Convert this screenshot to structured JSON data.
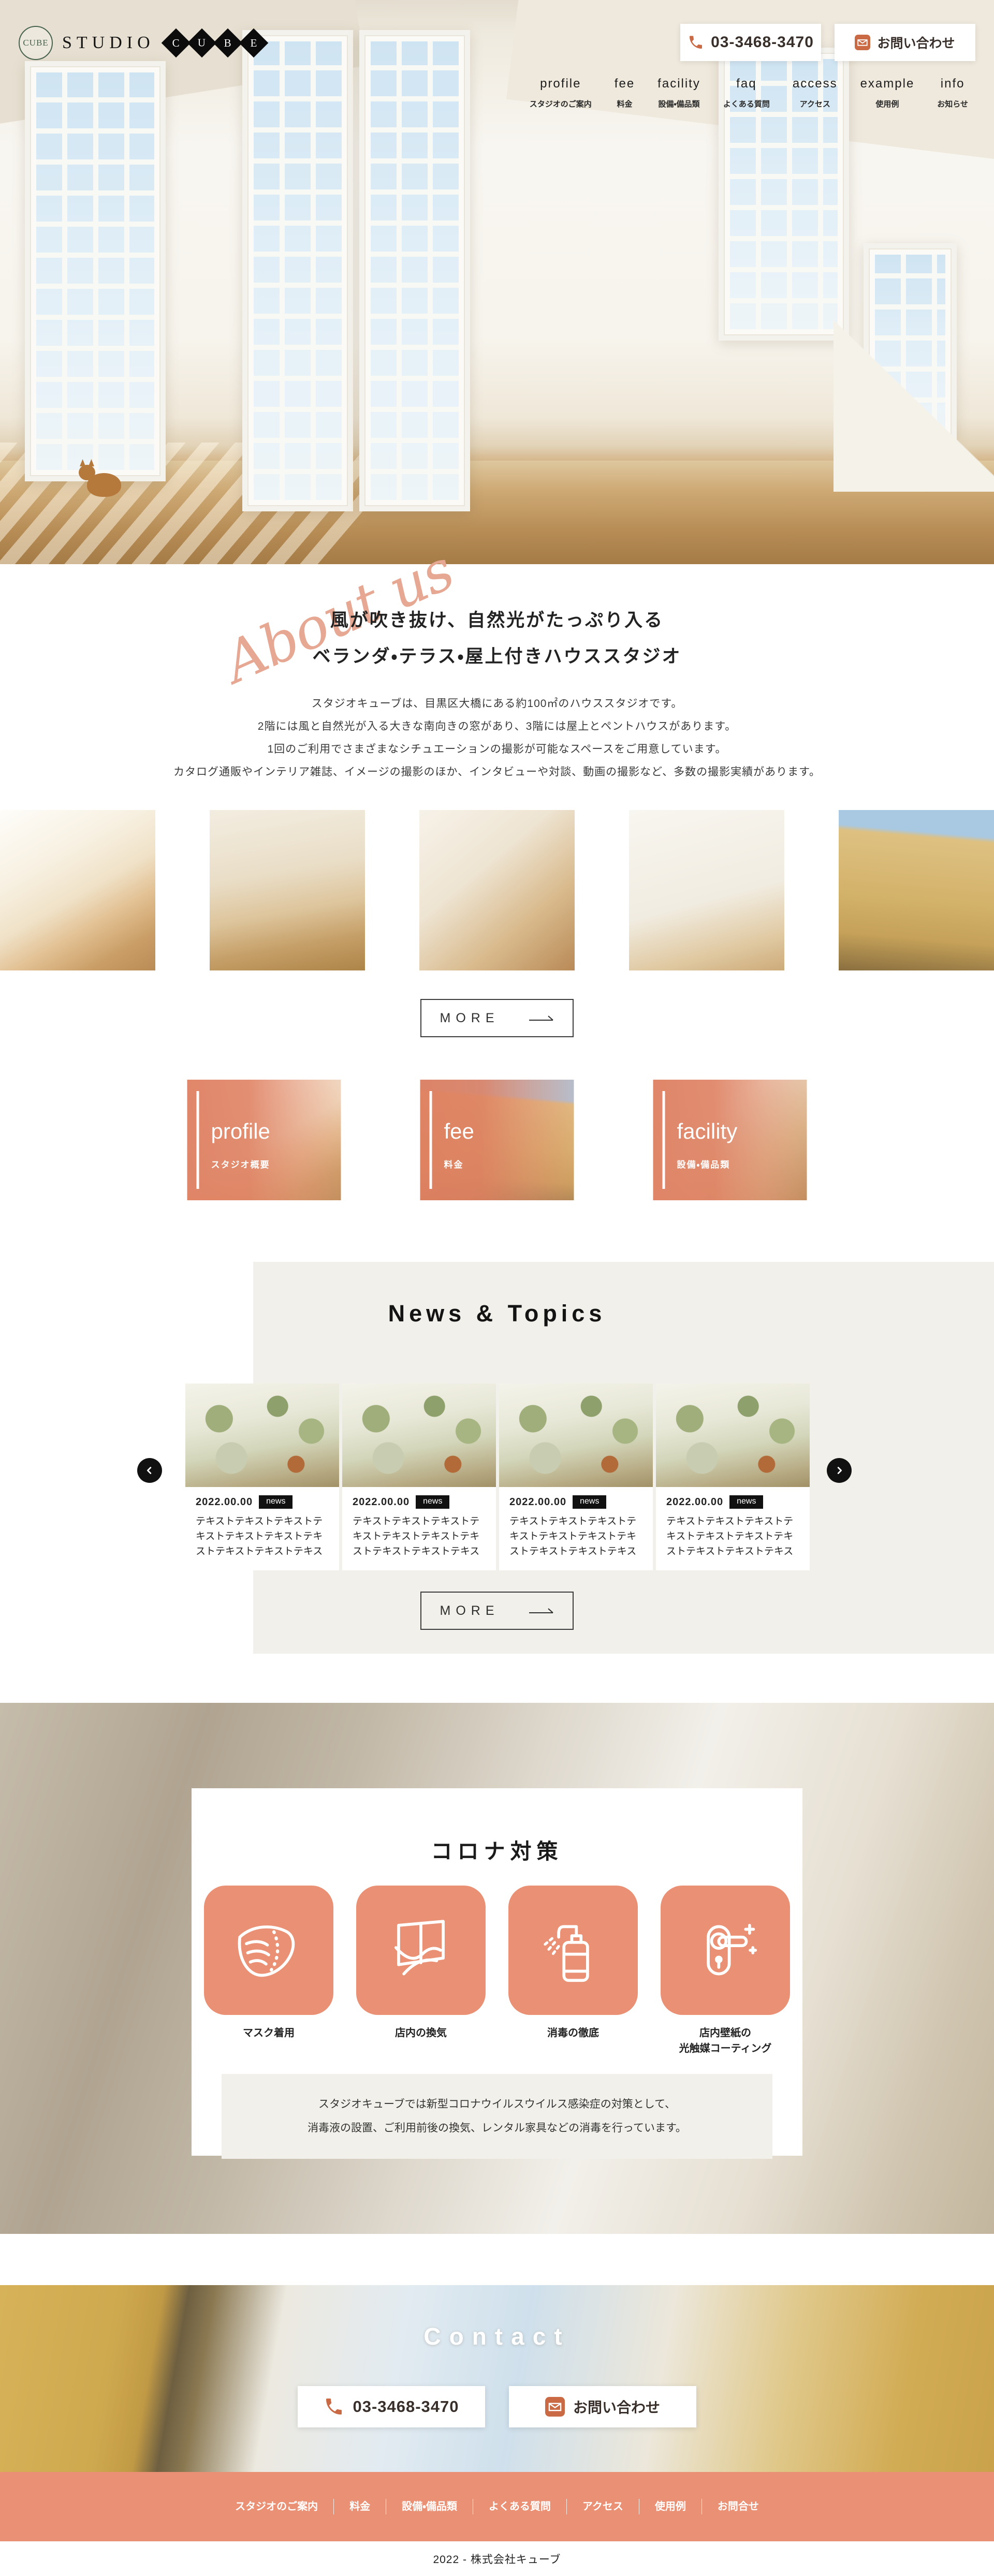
{
  "logo": {
    "emblem": "CUBE",
    "studio": "STUDIO",
    "cube": [
      "C",
      "U",
      "B",
      "E"
    ]
  },
  "header": {
    "phone": "03-3468-3470",
    "contact_label": "お問い合わせ",
    "nav": [
      {
        "en": "profile",
        "jp": "スタジオのご案内"
      },
      {
        "en": "fee",
        "jp": "料金"
      },
      {
        "en": "facility",
        "jp": "設備・備品類"
      },
      {
        "en": "faq",
        "jp": "よくある質問"
      },
      {
        "en": "access",
        "jp": "アクセス"
      },
      {
        "en": "example",
        "jp": "使用例"
      },
      {
        "en": "info",
        "jp": "お知らせ"
      }
    ]
  },
  "about": {
    "script": "About us",
    "heading1": "風が吹き抜け、自然光がたっぷり入る",
    "heading2": "ベランダ・テラス・屋上付きハウススタジオ",
    "p1": "スタジオキューブは、目黒区大橋にある約100㎡のハウススタジオです。",
    "p2": "2階には風と自然光が入る大きな南向きの窓があり、3階には屋上とペントハウスがあります。",
    "p3": "1回のご利用でさまざまなシチュエーションの撮影が可能なスペースをご用意しています。",
    "p4": "カタログ通販やインテリア雑誌、イメージの撮影のほか、インタビューや対談、動画の撮影など、多数の撮影実績があります。",
    "more": "MORE"
  },
  "menu_cards": [
    {
      "en": "profile",
      "jp": "スタジオ概要"
    },
    {
      "en": "fee",
      "jp": "料金"
    },
    {
      "en": "facility",
      "jp": "設備・備品類"
    }
  ],
  "news": {
    "title": "News & Topics",
    "more": "MORE",
    "items": [
      {
        "date": "2022.00.00",
        "badge": "news",
        "text": "テキストテキストテキストテキストテキストテキストテキストテキストテキストテキストテ"
      },
      {
        "date": "2022.00.00",
        "badge": "news",
        "text": "テキストテキストテキストテキストテキストテキストテキストテキストテキストテキストテ"
      },
      {
        "date": "2022.00.00",
        "badge": "news",
        "text": "テキストテキストテキストテキストテキストテキストテキストテキストテキストテキストテ"
      },
      {
        "date": "2022.00.00",
        "badge": "news",
        "text": "テキストテキストテキストテキストテキストテキストテキストテキストテキストテキストテ"
      }
    ]
  },
  "corona": {
    "title": "コロナ対策",
    "measures": [
      {
        "label": "マスク着用"
      },
      {
        "label": "店内の換気"
      },
      {
        "label": "消毒の徹底"
      },
      {
        "label": "店内壁紙の",
        "label2": "光触媒コーティング"
      }
    ],
    "note1": "スタジオキューブでは新型コロナウイルスウイルス感染症の対策として、",
    "note2": "消毒液の設置、ご利用前後の換気、レンタル家具などの消毒を行っています。"
  },
  "contact": {
    "title": "Contact",
    "phone": "03-3468-3470",
    "button": "お問い合わせ"
  },
  "footer": {
    "links": [
      "スタジオのご案内",
      "料金",
      "設備・備品類",
      "よくある質問",
      "アクセス",
      "使用例",
      "お問合せ"
    ],
    "copyright": "2022 - 株式会社キューブ"
  },
  "colors": {
    "accent": "#EA9175",
    "accent_deep": "#C96A45",
    "beige": "#F1F0EA",
    "ink": "#222222"
  }
}
